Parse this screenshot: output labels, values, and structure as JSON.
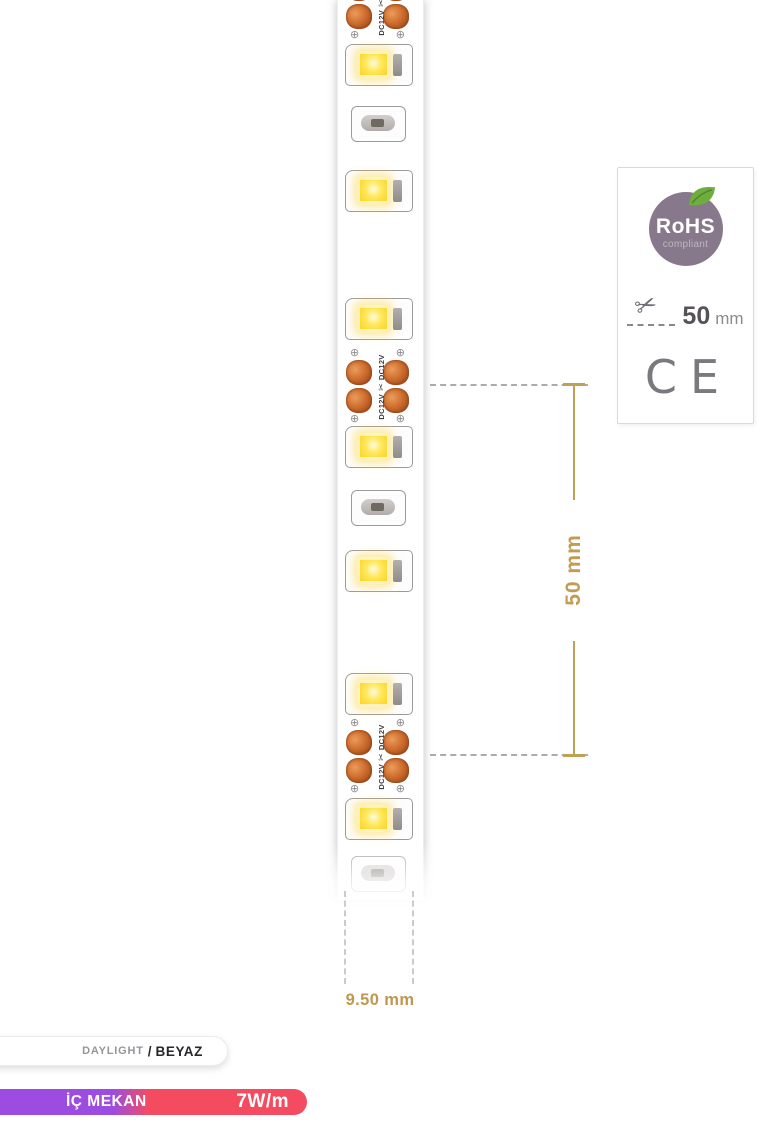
{
  "product": {
    "strip": {
      "dc_label": "DC12V",
      "scissors_icon": "✂",
      "screw_icon": "⊕"
    },
    "dimensions": {
      "cut_length": "50 mm",
      "strip_width": "9.50 mm"
    }
  },
  "cert_box": {
    "rohs_title": "RoHS",
    "rohs_subtitle": "compliant",
    "cut_value": "50",
    "cut_unit": "mm",
    "ce_mark": "CE"
  },
  "footer": {
    "color_name_en": "DAYLIGHT",
    "separator": "/",
    "color_name_tr": "BEYAZ",
    "usage_label": "İÇ MEKAN",
    "power_label": "7W/m"
  },
  "colors": {
    "accent_gold": "#c09750",
    "copper_pad": "#cd6d2e",
    "led_yellow": "#ffd42a",
    "usage_purple": "#9c4ce1",
    "power_red": "#f54b61",
    "rohs_badge": "#87798b",
    "leaf_green": "#6fae3e"
  }
}
